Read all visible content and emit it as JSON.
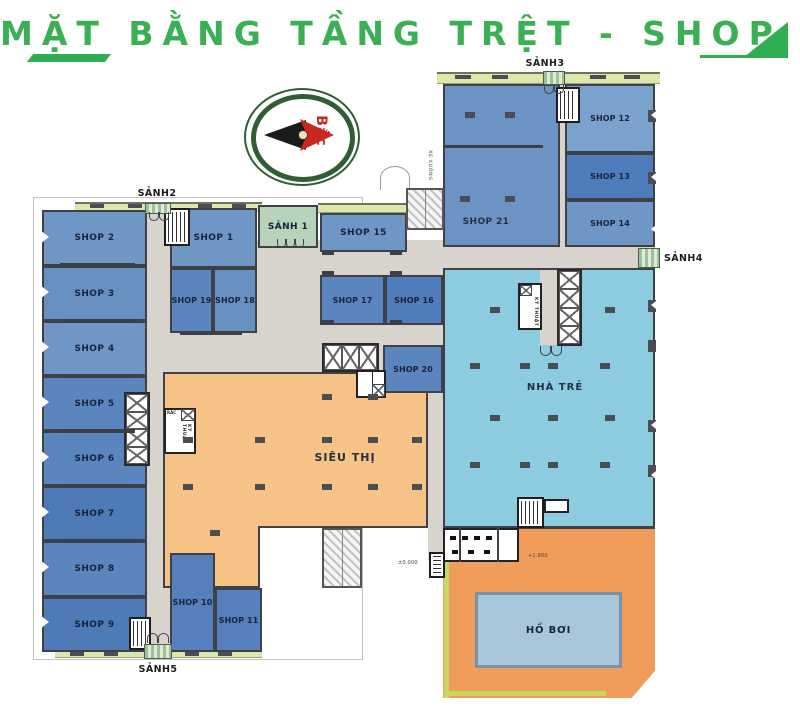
{
  "header": {
    "title": "MẶT BẰNG TẦNG TRỆT - SHOP HOUSE"
  },
  "compass": {
    "north_label": "Bắc"
  },
  "lobbies": {
    "sanh1": "SẢNH 1",
    "sanh2": "SẢNH2",
    "sanh3": "SẢNH3",
    "sanh4": "SẢNH4",
    "sanh5": "SẢNH5"
  },
  "shops": {
    "shop1": "SHOP 1",
    "shop2": "SHOP 2",
    "shop3": "SHOP 3",
    "shop4": "SHOP 4",
    "shop5": "SHOP 5",
    "shop6": "SHOP 6",
    "shop7": "SHOP 7",
    "shop8": "SHOP 8",
    "shop9": "SHOP 9",
    "shop10": "SHOP 10",
    "shop11": "SHOP 11",
    "shop12": "SHOP 12",
    "shop13": "SHOP 13",
    "shop14": "SHOP 14",
    "shop15": "SHOP 15",
    "shop16": "SHOP 16",
    "shop17": "SHOP 17",
    "shop18": "SHOP 18",
    "shop19": "SHOP 19",
    "shop20": "SHOP 20",
    "shop21": "SHOP 21"
  },
  "areas": {
    "supermarket": "SIÊU THỊ",
    "kindergarten": "NHÀ TRẺ",
    "pool": "HỒ BƠI"
  },
  "technical": {
    "kythuat": "KỸ THUẬT",
    "trash": "RÁC",
    "ramp_down": "XE XUỐNG"
  },
  "levels": {
    "ground": "±0.000",
    "pool_deck": "+1.900"
  },
  "colors": {
    "brand_green": "#2fae52",
    "title_green": "#3bb052",
    "shop_blue": "#6f97c6",
    "kindergarten_cyan": "#8ccbe0",
    "supermarket_orange": "#f6c286",
    "pool_deck_orange": "#f09c5a",
    "pool_water": "#a9c6d8",
    "corridor_gray": "#d8d4cd"
  }
}
